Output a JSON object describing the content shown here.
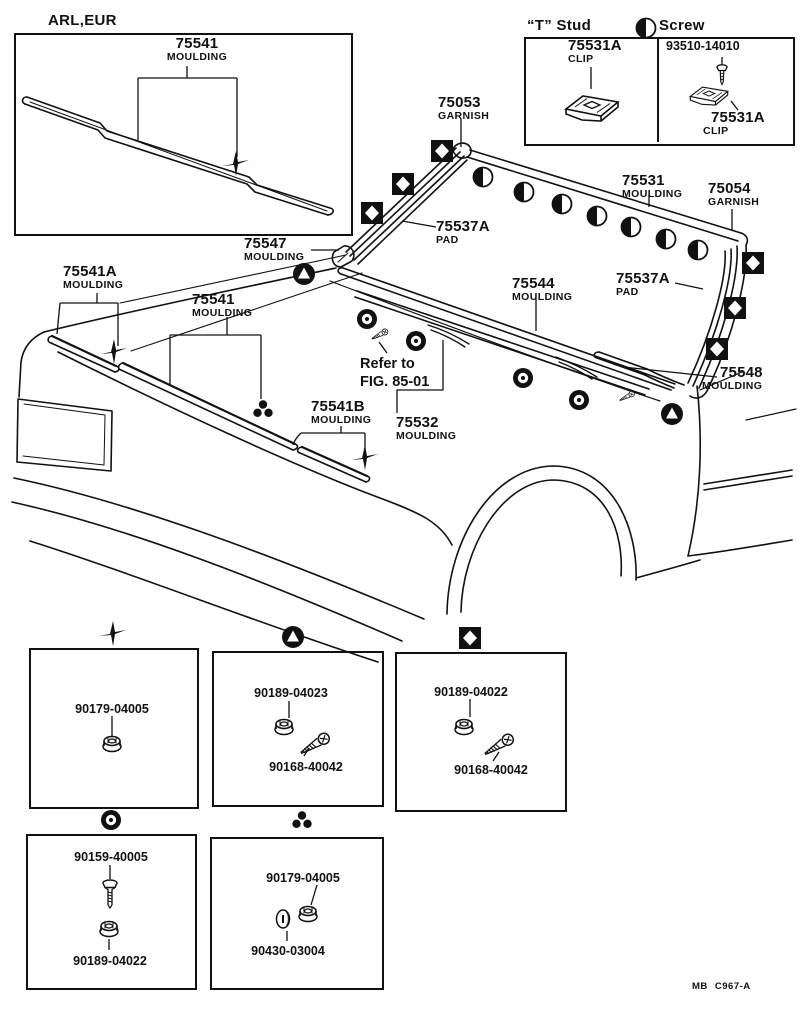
{
  "inset": {
    "region_label": "ARL,EUR",
    "part_number": "75541",
    "part_name": "MOULDING"
  },
  "legend": {
    "stud_title": "“T” Stud",
    "screw_title": "Screw",
    "stud_clip_number": "75531A",
    "stud_clip_name": "CLIP",
    "screw_number": "93510-14010",
    "screw_clip_number": "75531A",
    "screw_clip_name": "CLIP"
  },
  "labels": {
    "garnish_left": {
      "number": "75053",
      "name": "GARNISH"
    },
    "pad_left": {
      "number": "75537A",
      "name": "PAD"
    },
    "moulding_top": {
      "number": "75531",
      "name": "MOULDING"
    },
    "garnish_right": {
      "number": "75054",
      "name": "GARNISH"
    },
    "corner_left": {
      "number": "75547",
      "name": "MOULDING"
    },
    "moulding_lower": {
      "number": "75544",
      "name": "MOULDING"
    },
    "pad_right": {
      "number": "75537A",
      "name": "PAD"
    },
    "corner_right": {
      "number": "75548",
      "name": "MOULDING"
    },
    "fender": {
      "number": "75541A",
      "name": "MOULDING"
    },
    "hood": {
      "number": "75541",
      "name": "MOULDING"
    },
    "hood_rear": {
      "number": "75541B",
      "name": "MOULDING"
    },
    "windshield_lower": {
      "number": "75532",
      "name": "MOULDING"
    }
  },
  "note": {
    "line1": "Refer to",
    "line2": "FIG. 85-01"
  },
  "fasteners": {
    "box1": {
      "symbol": "cross",
      "item1": "90179-04005"
    },
    "box2": {
      "symbol": "triangle-in-circle",
      "item1": "90189-04023",
      "item2": "90168-40042"
    },
    "box3": {
      "symbol": "diamond-in-square",
      "item1": "90189-04022",
      "item2": "90168-40042"
    },
    "box4": {
      "symbol": "ring",
      "item1": "90159-40005",
      "item2": "90189-04022"
    },
    "box5": {
      "symbol": "three-dots",
      "item1": "90179-04005",
      "item2": "90430-03004"
    }
  },
  "footer": {
    "code": "MB C967-A"
  },
  "colors": {
    "ink": "#111111",
    "paper": "#ffffff"
  }
}
